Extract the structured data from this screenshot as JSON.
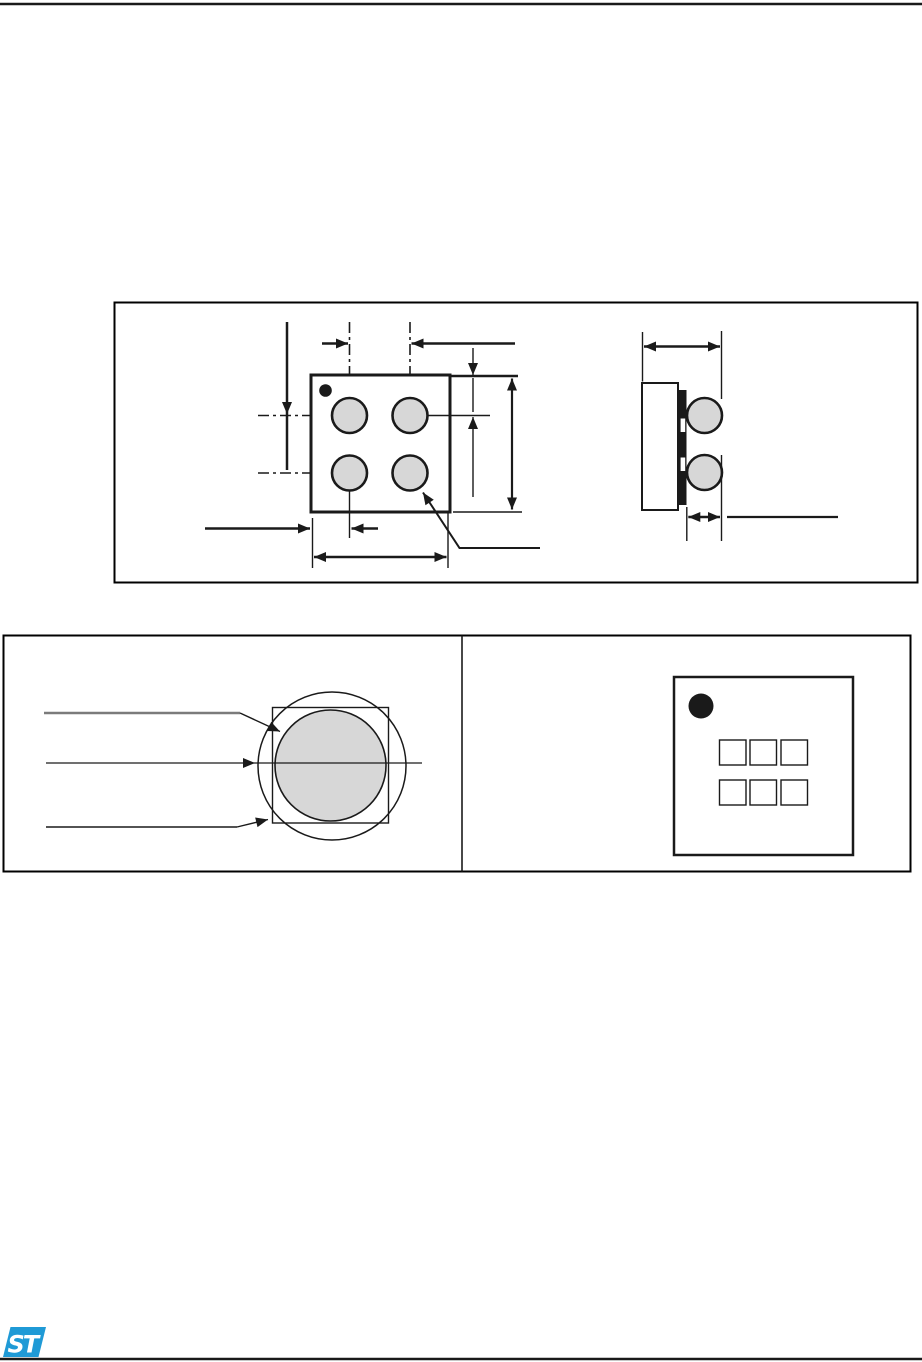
{
  "page": {
    "kind": "datasheet mechanical drawing page",
    "background": "#ffffff",
    "visible_text": ""
  },
  "branding": {
    "logo_text": "ST",
    "logo_color": "#1f9ad6",
    "logo_text_color": "#ffffff"
  },
  "colors": {
    "line": "#1a1a1a",
    "frame": "#000000",
    "ball_fill": "#d7d7d7",
    "leader_gray": "#7b7b7b"
  },
  "figures": {
    "package_outline_figure": {
      "bottom_view_bump_count": 4,
      "bottom_view_has_pin1_index_dot": true,
      "side_view_bump_count": 2,
      "dimension_labels_visible": false
    },
    "detail_and_marking_figure": {
      "left_panel": "bump-detail-with-concentric-circles-and-square",
      "left_panel_leader_count": 3,
      "right_panel": "marking-area-with-pin1-dot",
      "marking_char_box_count": 6,
      "marking_char_box_rows": 2,
      "marking_char_box_columns": 3
    }
  }
}
